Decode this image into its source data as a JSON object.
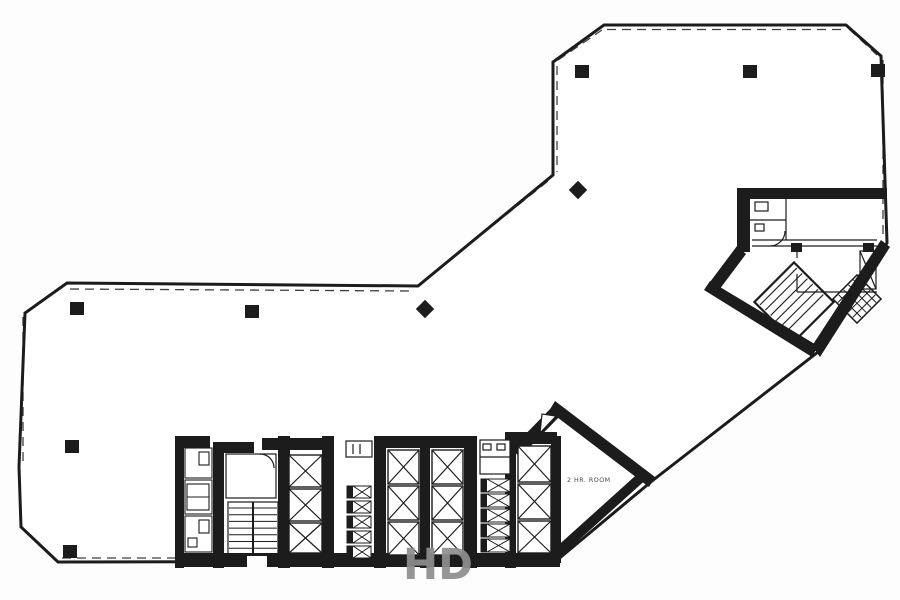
{
  "document": {
    "type": "scanned architectural floor plan",
    "watermark": "HD"
  },
  "labels": {
    "room": "2 HR. ROOM"
  },
  "colors": {
    "wall": "#1c1c1c",
    "background": "#fdfdfd",
    "watermark": "#8e8e8e",
    "label": "#4a4a4a"
  },
  "structure": {
    "columns_square": [
      [
        575,
        65
      ],
      [
        743,
        65
      ],
      [
        871,
        64
      ],
      [
        70,
        302
      ],
      [
        245,
        305
      ],
      [
        65,
        440
      ],
      [
        63,
        545
      ]
    ],
    "columns_diamond": [
      [
        578,
        190
      ],
      [
        425,
        309
      ]
    ],
    "elevator_shafts": [
      [
        289,
        455,
        33,
        32
      ],
      [
        289,
        489,
        33,
        32
      ],
      [
        289,
        523,
        33,
        30
      ],
      [
        388,
        450,
        31,
        34
      ],
      [
        388,
        486,
        31,
        34
      ],
      [
        388,
        522,
        31,
        33
      ],
      [
        432,
        450,
        31,
        34
      ],
      [
        432,
        486,
        31,
        34
      ],
      [
        432,
        522,
        31,
        33
      ],
      [
        518,
        446,
        33,
        36
      ],
      [
        518,
        484,
        33,
        35
      ],
      [
        518,
        521,
        33,
        32
      ]
    ],
    "duct_strips": [
      {
        "x": 347,
        "w": 24,
        "h": 12,
        "rows": [
          486,
          501,
          516,
          531,
          546
        ]
      },
      {
        "x": 481,
        "w": 29,
        "h": 13,
        "rows": [
          479,
          494,
          509,
          524,
          539
        ]
      }
    ],
    "restroom_stalls": [
      [
        185,
        448,
        27,
        30
      ],
      [
        185,
        480,
        27,
        34
      ],
      [
        185,
        516,
        27,
        36
      ]
    ],
    "stair_treads": {
      "xA1": 229,
      "xA2": 252,
      "xB1": 254,
      "xB2": 277,
      "y_start": 508,
      "y_end": 549,
      "step": 6.7
    }
  }
}
